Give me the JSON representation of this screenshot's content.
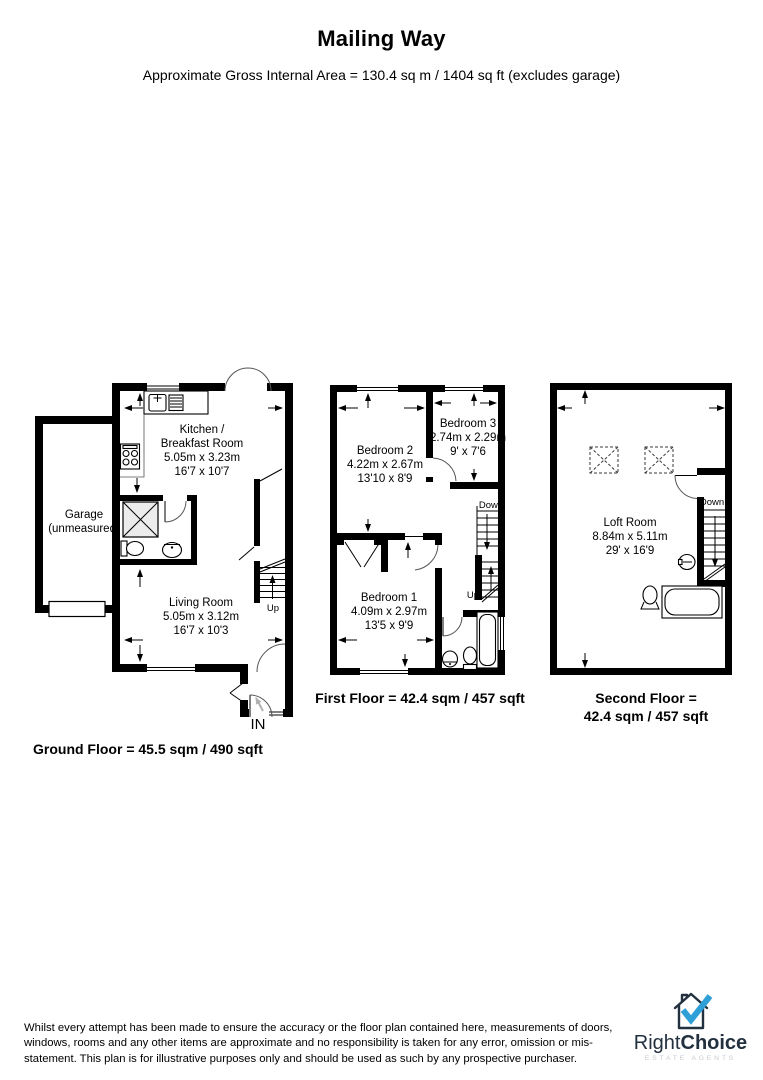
{
  "page": {
    "title": "Mailing Way",
    "subtitle": "Approximate Gross Internal Area = 130.4 sq m / 1404 sq ft (excludes garage)"
  },
  "ground_floor": {
    "caption": "Ground Floor = 45.5 sqm / 490 sqft",
    "rooms": {
      "kitchen": {
        "name_line1": "Kitchen /",
        "name_line2": "Breakfast Room",
        "dim_metric": "5.05m x 3.23m",
        "dim_imperial": "16'7 x 10'7"
      },
      "garage": {
        "name": "Garage",
        "note": "(unmeasured)"
      },
      "living": {
        "name": "Living Room",
        "dim_metric": "5.05m x 3.12m",
        "dim_imperial": "16'7 x 10'3"
      }
    },
    "labels": {
      "up": "Up",
      "in": "IN"
    }
  },
  "first_floor": {
    "caption": "First Floor = 42.4 sqm / 457 sqft",
    "rooms": {
      "bedroom2": {
        "name": "Bedroom 2",
        "dim_metric": "4.22m x 2.67m",
        "dim_imperial": "13'10 x 8'9"
      },
      "bedroom3": {
        "name": "Bedroom 3",
        "dim_metric": "2.74m x 2.29m",
        "dim_imperial": "9' x 7'6"
      },
      "bedroom1": {
        "name": "Bedroom 1",
        "dim_metric": "4.09m x 2.97m",
        "dim_imperial": "13'5 x 9'9"
      }
    },
    "labels": {
      "down": "Down",
      "up": "Up"
    }
  },
  "second_floor": {
    "caption_line1": "Second Floor =",
    "caption_line2": "42.4 sqm / 457 sqft",
    "rooms": {
      "loft": {
        "name": "Loft Room",
        "dim_metric": "8.84m x 5.11m",
        "dim_imperial": "29' x 16'9"
      }
    },
    "labels": {
      "down": "Down"
    }
  },
  "disclaimer": "Whilst every attempt has been made to ensure the accuracy or the floor plan contained here, measurements of doors, windows, rooms and any other items are approximate and no responsibility is taken for any error, omission or mis-statement. This plan is for illustrative purposes only and should be used as such by any prospective purchaser.",
  "logo": {
    "brand_first": "Right",
    "brand_second": "Choice",
    "tagline": "ESTATE AGENTS",
    "colors": {
      "navy": "#22303f",
      "blue": "#2f9fd8",
      "gray": "#c6cbd0"
    }
  }
}
